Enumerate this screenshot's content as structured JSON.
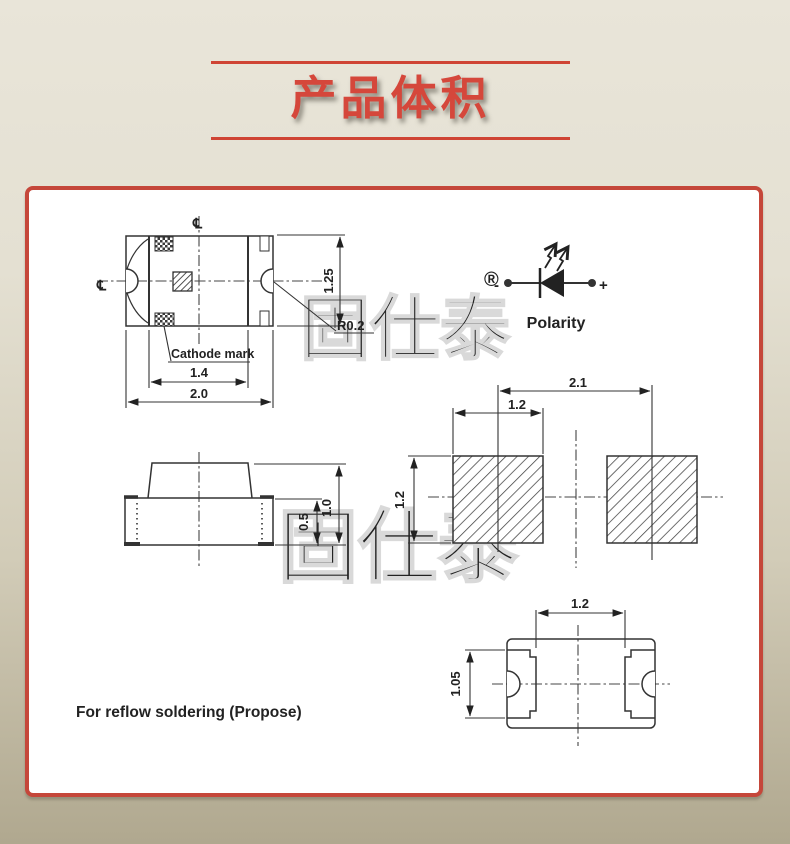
{
  "header": {
    "title": "产品体积"
  },
  "watermark": {
    "text": "固仕泰",
    "registered": "®"
  },
  "top_view": {
    "centerline_top": "℄",
    "centerline_left": "℄",
    "dim_height": "1.25",
    "dim_radius": "R0.2",
    "cathode_label": "Cathode mark",
    "dim_inner_width": "1.4",
    "dim_outer_width": "2.0"
  },
  "polarity": {
    "minus": "-",
    "plus": "+",
    "label": "Polarity"
  },
  "side_view": {
    "dim_base_height": "0.5",
    "dim_total_height": "1.0"
  },
  "pad_layout": {
    "dim_pitch": "2.1",
    "dim_pad_width": "1.2",
    "dim_pad_height": "1.2"
  },
  "footprint": {
    "dim_gap": "1.2",
    "dim_terminal_height": "1.05"
  },
  "note": {
    "reflow": "For reflow soldering (Propose)"
  },
  "colors": {
    "accent_red": "#cf4434",
    "panel_border": "#c5473a",
    "line": "#333333",
    "plus_blue": "#2b50c8",
    "background_top": "#e9e5d9",
    "background_bottom": "#b0a88f"
  }
}
